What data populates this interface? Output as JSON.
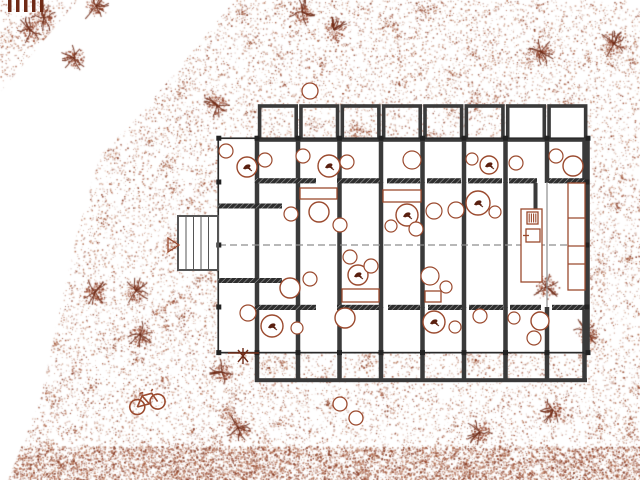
{
  "canvas": {
    "w": 640,
    "h": 480
  },
  "colors": {
    "paper": "#ffffff",
    "wall": "#3a3a3a",
    "wall_dark": "#222222",
    "facade": "#2a2a2a",
    "gridline": "#8d8d8d",
    "hatch_bg": "#2e2e2e",
    "hatch_line": "#a8a8a8",
    "ink": "#9b4a2e",
    "ink_light": "#c08a72",
    "ink_dark": "#6f2a16",
    "glyph": "#5a2010",
    "deck": "#555555"
  },
  "site": {
    "texture": {
      "seed": 7,
      "base_dots": 27000,
      "clusters": 240,
      "cluster_dots": 26,
      "cluster_r": 9,
      "strip_dots": 5200,
      "strip_y": 446,
      "strip_h": 34,
      "palette": [
        "#9c4a2e",
        "#8a3c26",
        "#b06a4a",
        "#c9937a",
        "#7c3018"
      ]
    },
    "white_wedge": [
      [
        78,
        0
      ],
      [
        235,
        0
      ],
      [
        140,
        115
      ],
      [
        100,
        155
      ],
      [
        78,
        230
      ],
      [
        62,
        300
      ],
      [
        40,
        400
      ],
      [
        8,
        480
      ],
      [
        0,
        480
      ],
      [
        0,
        92
      ]
    ],
    "bushes": [
      [
        44,
        18
      ],
      [
        74,
        58
      ],
      [
        302,
        12
      ],
      [
        334,
        30
      ],
      [
        541,
        52
      ],
      [
        614,
        44
      ],
      [
        95,
        292
      ],
      [
        136,
        291
      ],
      [
        140,
        334
      ],
      [
        546,
        287
      ],
      [
        553,
        410
      ],
      [
        222,
        372
      ],
      [
        238,
        428
      ],
      [
        586,
        332
      ],
      [
        480,
        432
      ],
      [
        217,
        105
      ],
      [
        30,
        30
      ],
      [
        96,
        6
      ]
    ],
    "fence": {
      "x": 8,
      "y": 0,
      "count": 5,
      "bar_w": 3.5,
      "step": 8,
      "h": 12
    },
    "bicycle": {
      "x": 146,
      "y": 399,
      "angle": -15,
      "wheel_r": 7.5,
      "wheel_dx": 10.5
    },
    "triangle": [
      [
        168,
        252
      ],
      [
        168,
        238
      ],
      [
        179,
        245
      ]
    ],
    "plant": {
      "x": 243,
      "y": 356,
      "line_x1": 228,
      "line_x2": 259,
      "line_y": 353
    },
    "deck": {
      "x": 178,
      "y": 216,
      "w": 40,
      "h": 54,
      "planks": [
        186,
        193.5,
        201,
        208.5
      ]
    },
    "trees": [
      [
        310,
        91,
        8
      ],
      [
        340,
        404,
        7
      ],
      [
        356,
        418,
        7
      ]
    ]
  },
  "building": {
    "envelope": {
      "x": 218,
      "y": 138,
      "w": 372,
      "h": 215
    },
    "white_top_bays": [
      [
        507.5,
        106,
        36,
        34
      ],
      [
        549,
        106,
        37,
        34
      ]
    ],
    "top_bays": {
      "x0": 259.6,
      "w": 36.6,
      "step": 41.35,
      "count": 8,
      "y": 106,
      "h": 34,
      "stroke_w": 3.6
    },
    "vwalls": {
      "x": [
        257,
        298,
        339.5,
        381,
        422.5,
        464,
        505.5,
        547,
        584.5
      ],
      "w": 4.5,
      "top_y1": 140,
      "top_y2": 183,
      "hall_y1": 182,
      "hall_y2": 308,
      "hall_idx": [
        0,
        1,
        2,
        3,
        4,
        5,
        6
      ],
      "thin_idx": 7,
      "bot_y1": 307,
      "bot_y2": 382
    },
    "bottom_cap": {
      "x": 255,
      "y": 378.2,
      "w": 332,
      "h": 4
    },
    "band_top": {
      "y": 178.2,
      "h": 5.2,
      "segs": [
        [
          255,
          316
        ],
        [
          337,
          380
        ],
        [
          387,
          420
        ],
        [
          427,
          461
        ],
        [
          468,
          502
        ],
        [
          509,
          537
        ],
        [
          549,
          586
        ]
      ]
    },
    "band_bottom": {
      "y": 304.8,
      "h": 5.2,
      "segs": [
        [
          255,
          316
        ],
        [
          337,
          379
        ],
        [
          388,
          420
        ],
        [
          428,
          462
        ],
        [
          469,
          503
        ],
        [
          510,
          541
        ],
        [
          552,
          586
        ]
      ]
    },
    "facade_top": {
      "x": 218,
      "y": 137.4,
      "w": 372,
      "h": 1.7
    },
    "facade_bottom": {
      "x": 218,
      "y": 351.8,
      "w": 372,
      "h": 1.7
    },
    "facade_left": {
      "x": 217.4,
      "y": 138,
      "w": 1.7,
      "h": 215
    },
    "facade_right": {
      "x": 584.3,
      "y": 138,
      "w": 5.5,
      "h": 215
    },
    "midline": {
      "y": 245,
      "x1": 219,
      "x2": 584,
      "dash": "7,4"
    },
    "kitchen_stub": {
      "x": 533.5,
      "y": 183,
      "w": 4,
      "h": 26
    },
    "vestibule_bars": [
      [
        218,
        203.5,
        64,
        5
      ],
      [
        218,
        278,
        64,
        5
      ]
    ],
    "tick_size": 5,
    "ticks_x": [
      218.8,
      257,
      298,
      339.5,
      381,
      422.5,
      464,
      505.5,
      547,
      588
    ],
    "ticks_y_rows": [
      138.2,
      352.6
    ],
    "side_ticks_y": [
      182,
      245,
      307
    ],
    "side_ticks_x": [
      218.8,
      587
    ]
  },
  "furniture": {
    "circles": [
      [
        226,
        151,
        7,
        "c"
      ],
      [
        247,
        167,
        10,
        "g"
      ],
      [
        265,
        160,
        7,
        "c"
      ],
      [
        303,
        156,
        7,
        "c"
      ],
      [
        329,
        166,
        11,
        "g"
      ],
      [
        347,
        162,
        7,
        "c"
      ],
      [
        412,
        160,
        9,
        "c"
      ],
      [
        472,
        159,
        6,
        "c"
      ],
      [
        489,
        165,
        9,
        "g"
      ],
      [
        516,
        163,
        7,
        "c"
      ],
      [
        556,
        156,
        7,
        "c"
      ],
      [
        573,
        166,
        10,
        "t"
      ],
      [
        291,
        214,
        7,
        "c"
      ],
      [
        319,
        212,
        10,
        "t"
      ],
      [
        340,
        225,
        7,
        "c"
      ],
      [
        391,
        226,
        6,
        "c"
      ],
      [
        407,
        215,
        11,
        "g"
      ],
      [
        416,
        229,
        7,
        "c"
      ],
      [
        434,
        211,
        8,
        "c"
      ],
      [
        456,
        210,
        8,
        "c"
      ],
      [
        478,
        203,
        12,
        "g"
      ],
      [
        495,
        212,
        6,
        "c"
      ],
      [
        350,
        257,
        7,
        "c"
      ],
      [
        358,
        275,
        10,
        "g"
      ],
      [
        371,
        266,
        7,
        "c"
      ],
      [
        290,
        288,
        10,
        "t"
      ],
      [
        310,
        279,
        7,
        "c"
      ],
      [
        430,
        276,
        9,
        "c"
      ],
      [
        446,
        287,
        6,
        "c"
      ],
      [
        530,
        271,
        8,
        "d"
      ],
      [
        248,
        313,
        8,
        "c"
      ],
      [
        272,
        326,
        11,
        "g"
      ],
      [
        297,
        328,
        6,
        "c"
      ],
      [
        345,
        318,
        10,
        "t"
      ],
      [
        434,
        322,
        11,
        "g"
      ],
      [
        455,
        327,
        6,
        "c"
      ],
      [
        480,
        316,
        7,
        "c"
      ],
      [
        514,
        318,
        6,
        "c"
      ],
      [
        540,
        321,
        9,
        "t"
      ],
      [
        534,
        338,
        7,
        "c"
      ]
    ],
    "rects": [
      [
        300,
        188,
        37,
        11,
        "r"
      ],
      [
        383,
        190,
        38,
        12,
        "r"
      ],
      [
        342,
        289,
        37,
        13,
        "r"
      ],
      [
        425,
        291,
        16,
        11,
        "r"
      ],
      [
        521,
        209,
        21,
        73,
        "counter"
      ],
      [
        527,
        212,
        11,
        12,
        "stove"
      ],
      [
        526,
        229,
        14,
        13,
        "sink"
      ],
      [
        568,
        183,
        17,
        107,
        "shelf"
      ]
    ],
    "shelf_dividers": [
      35,
      63,
      81
    ]
  }
}
